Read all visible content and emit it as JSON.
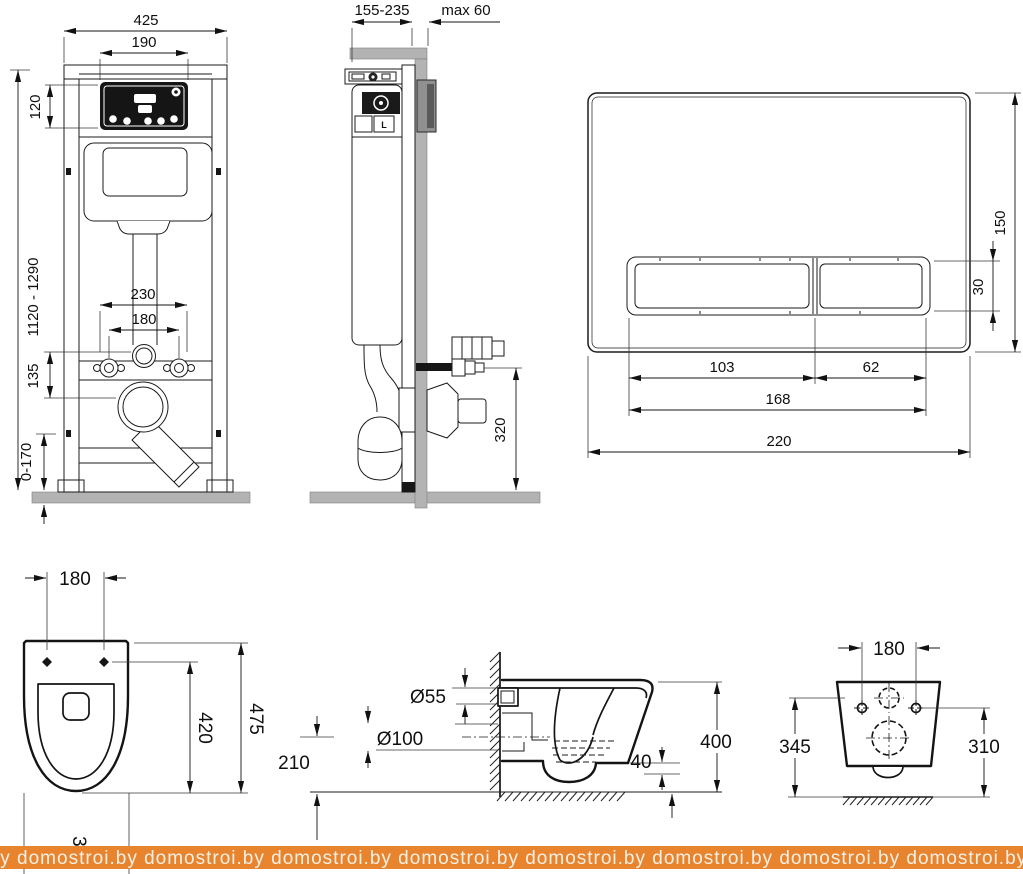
{
  "watermark": {
    "text": "domostroi.by",
    "repeat": 10
  },
  "frame_front": {
    "dims": {
      "total_width": "425",
      "opening_width": "190",
      "opening_height": "120",
      "height_range": "1120 - 1290",
      "rod_spacing": "230",
      "bolt_spacing": "180",
      "axis_offset": "135",
      "foot_range": "0-170"
    }
  },
  "frame_side": {
    "dims": {
      "depth_range": "155-235",
      "wall_max": "max 60",
      "inlet_height": "320"
    },
    "tank_label": "L"
  },
  "flush_plate": {
    "dims": {
      "height": "150",
      "button_height": "30",
      "button_big": "103",
      "button_small": "62",
      "buttons_total": "168",
      "width": "220"
    }
  },
  "toilet_top": {
    "dims": {
      "hole_spacing": "180",
      "bowl_depth": "420",
      "total_depth": "475",
      "width": "360"
    }
  },
  "toilet_side": {
    "dims": {
      "inlet_diameter": "Ø55",
      "outlet_diameter": "Ø100",
      "outlet_height": "210",
      "rim_gap": "40",
      "height": "400"
    }
  },
  "toilet_back": {
    "dims": {
      "hole_spacing": "180",
      "height_left": "345",
      "height_right": "310"
    }
  }
}
